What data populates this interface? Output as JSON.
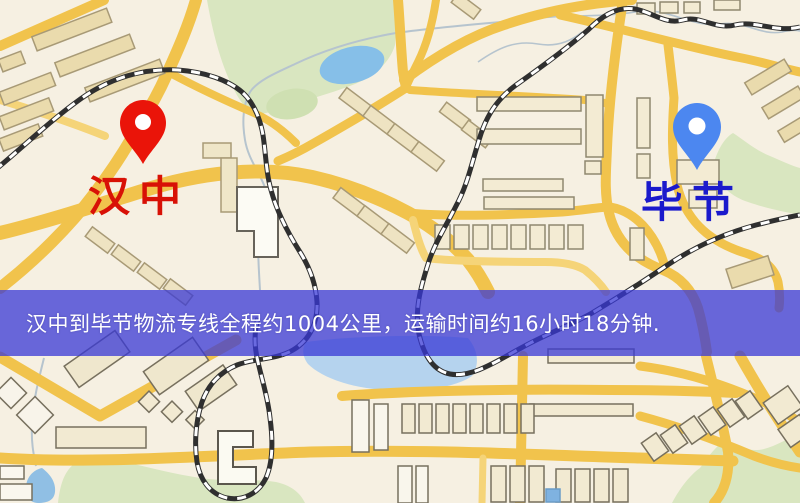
{
  "map": {
    "kind": "street-map-screenshot",
    "origin": {
      "label": "汉中",
      "label_color": "#d81106",
      "pin_color": "#ea1409",
      "pin_icon": "red-location-pin"
    },
    "destination": {
      "label": "毕节",
      "label_color": "#1b1acc",
      "pin_color": "#4c87f0",
      "pin_icon": "blue-location-pin"
    },
    "banner": {
      "text": "汉中到毕节物流专线全程约1004公里，运输时间约16小时18分钟.",
      "background": "#3838d6",
      "opacity": "0.75",
      "text_color": "#ffffff"
    },
    "route": {
      "distance_km": 1004,
      "duration_hours": 16,
      "duration_minutes": 18
    },
    "palette": {
      "map_background": "#f6f0e2",
      "road_major": "#f1c34c",
      "road_minor": "#f5d478",
      "park_green": "#d9e6c0",
      "water_blue": "#86bfe8",
      "building_tan": "#eadbad",
      "building_light": "#f3ebd3",
      "railway_dark": "#2f2f2f",
      "stream_grey": "#b6c4ce"
    }
  }
}
